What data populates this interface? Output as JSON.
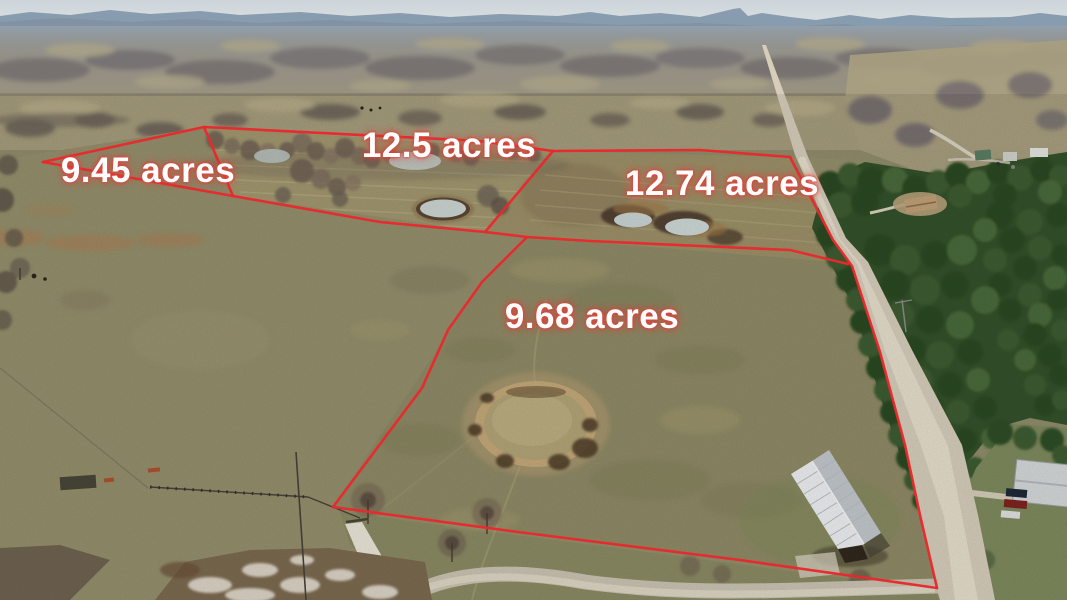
{
  "parcels": [
    {
      "name": "lot-a",
      "label": "9.45 acres"
    },
    {
      "name": "lot-b",
      "label": "12.5 acres"
    },
    {
      "name": "lot-c",
      "label": "12.74 acres"
    },
    {
      "name": "lot-d",
      "label": "9.68 acres"
    }
  ],
  "theme": {
    "boundary-color": "#e8282c",
    "label-text-color": "#ffffff",
    "label-glow-color": "#e04038"
  },
  "scene": {
    "type": "aerial-drone-photo",
    "landmarks": [
      "winter pastures",
      "stock ponds",
      "large muddy pond",
      "gravel county road",
      "pine forest",
      "metal-roof barn",
      "farmstead",
      "houses",
      "fence lines",
      "distant mountain ridge",
      "bare hardwood forest"
    ]
  }
}
